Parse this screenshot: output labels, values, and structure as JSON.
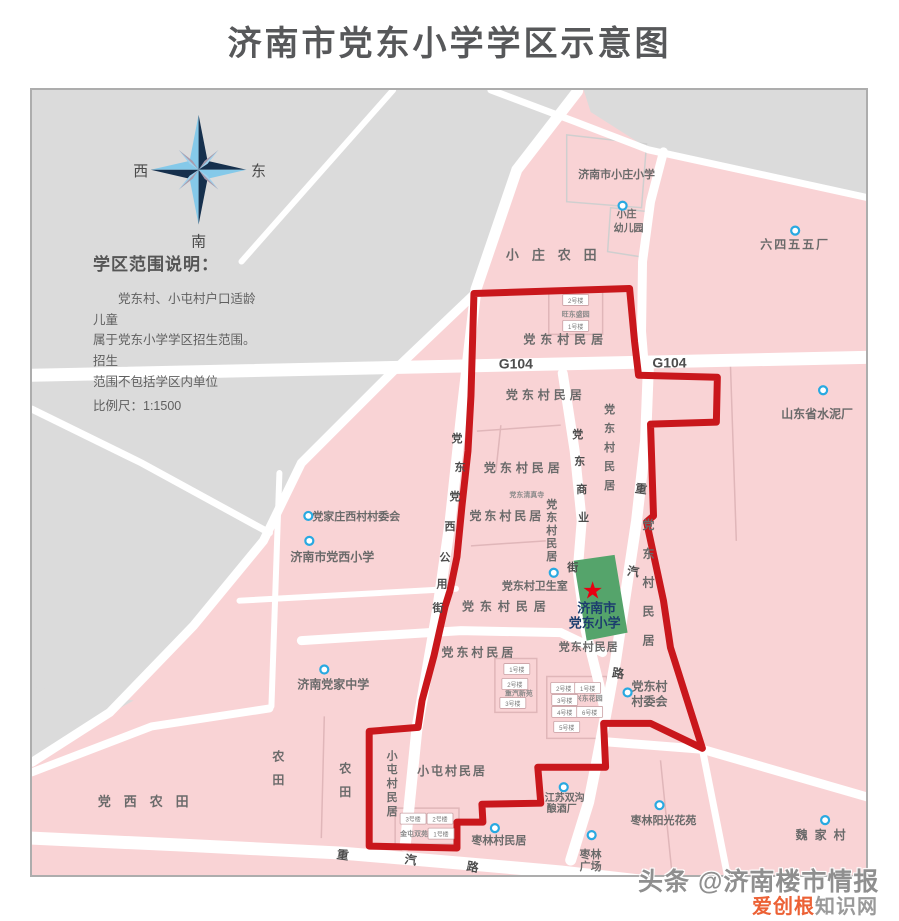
{
  "title": "济南市党东小学学区示意图",
  "compass": {
    "west": "西",
    "east": "东",
    "south": "南"
  },
  "legend": {
    "heading": "学区范围说明：",
    "body_lines": [
      "党东村、小屯村户口适龄儿童",
      "属于党东小学学区招生范围。招生",
      "范围不包括学区内单位"
    ],
    "scale_label": "比例尺：1:1500"
  },
  "school": {
    "name_line1": "济南市",
    "name_line2": "党东小学"
  },
  "watermark": {
    "line1": "头条 @济南楼市情报",
    "brand_orange": "爱创根",
    "brand_gray": "知识网"
  },
  "colors": {
    "pink": "#f9d3d5",
    "gray": "#dbdbdb",
    "road": "#ffffff",
    "boundary_red": "#c9171c",
    "area_label": "#6a6a6a",
    "road_label": "#4d4d4d",
    "small_label": "#8a8a8a",
    "school_green": "#55a46b",
    "school_text": "#1c3d6e",
    "star_red": "#e60012",
    "marker_blue": "#29a9e1"
  },
  "map": {
    "labels": [
      {
        "t": "G104",
        "x": 515,
        "y": 367,
        "s": 14,
        "c": "road"
      },
      {
        "t": "G104",
        "x": 669,
        "y": 366,
        "s": 14,
        "c": "road"
      },
      {
        "t": "党",
        "x": 456,
        "y": 441,
        "s": 11,
        "c": "road"
      },
      {
        "t": "东",
        "x": 459,
        "y": 470,
        "s": 11,
        "c": "road"
      },
      {
        "t": "党",
        "x": 454,
        "y": 499,
        "s": 11,
        "c": "road"
      },
      {
        "t": "西",
        "x": 449,
        "y": 529,
        "s": 11,
        "c": "road"
      },
      {
        "t": "公",
        "x": 444,
        "y": 560,
        "s": 11,
        "c": "road"
      },
      {
        "t": "用",
        "x": 441,
        "y": 587,
        "s": 11,
        "c": "road"
      },
      {
        "t": "街",
        "x": 437,
        "y": 611,
        "s": 11,
        "c": "road"
      },
      {
        "t": "党",
        "x": 577,
        "y": 437,
        "s": 11,
        "c": "road"
      },
      {
        "t": "东",
        "x": 579,
        "y": 464,
        "s": 11,
        "c": "road"
      },
      {
        "t": "商",
        "x": 581,
        "y": 492,
        "s": 11,
        "c": "road"
      },
      {
        "t": "业",
        "x": 583,
        "y": 520,
        "s": 11,
        "c": "road"
      },
      {
        "t": "街",
        "x": 572,
        "y": 570,
        "s": 11,
        "c": "road"
      },
      {
        "t": "重",
        "x": 640,
        "y": 492,
        "s": 12,
        "c": "road",
        "r": 8
      },
      {
        "t": "汽",
        "x": 632,
        "y": 575,
        "s": 12,
        "c": "road",
        "r": 8
      },
      {
        "t": "路",
        "x": 617,
        "y": 677,
        "s": 12,
        "c": "road",
        "r": 8
      },
      {
        "t": "重",
        "x": 341,
        "y": 859,
        "s": 12,
        "c": "road",
        "r": 8
      },
      {
        "t": "汽",
        "x": 409,
        "y": 864,
        "s": 12,
        "c": "road",
        "r": 8
      },
      {
        "t": "路",
        "x": 471,
        "y": 871,
        "s": 12,
        "c": "road",
        "r": 10
      },
      {
        "t": "小庄农田",
        "x": 557,
        "y": 258,
        "s": 13,
        "ls": 13
      },
      {
        "t": "济南市小庄小学",
        "x": 616,
        "y": 176,
        "s": 11
      },
      {
        "t": "小庄",
        "x": 626,
        "y": 216,
        "s": 10
      },
      {
        "t": "幼儿园",
        "x": 628,
        "y": 230,
        "s": 10
      },
      {
        "t": "六四五五厂",
        "x": 795,
        "y": 247,
        "s": 12,
        "ls": 2
      },
      {
        "t": "党东村民居",
        "x": 565,
        "y": 342,
        "s": 12,
        "ls": 5
      },
      {
        "t": "党东村民居",
        "x": 545,
        "y": 398,
        "s": 12,
        "ls": 4
      },
      {
        "t": "党东村民居",
        "x": 609,
        "y": 412,
        "s": 11,
        "v": 1,
        "sp": 19
      },
      {
        "t": "党东村民居",
        "x": 523,
        "y": 471,
        "s": 12,
        "ls": 4
      },
      {
        "t": "党东清真寺",
        "x": 526,
        "y": 496,
        "s": 7,
        "c": "small"
      },
      {
        "t": "党东村民居",
        "x": 506,
        "y": 519,
        "s": 12,
        "ls": 3
      },
      {
        "t": "党东村民居",
        "x": 551,
        "y": 507,
        "s": 11,
        "v": 1,
        "sp": 13
      },
      {
        "t": "党东村卫生室",
        "x": 534,
        "y": 589,
        "s": 11
      },
      {
        "t": "党东村民居",
        "x": 506,
        "y": 610,
        "s": 12,
        "ls": 6
      },
      {
        "t": "党东村民居",
        "x": 478,
        "y": 656,
        "s": 12,
        "ls": 3
      },
      {
        "t": "党东村民居",
        "x": 588,
        "y": 650,
        "s": 11,
        "ls": 1
      },
      {
        "t": "党东村民居",
        "x": 648,
        "y": 528,
        "s": 12,
        "v": 1,
        "sp": 29
      },
      {
        "t": "党东村",
        "x": 649,
        "y": 690,
        "s": 12
      },
      {
        "t": "村委会",
        "x": 649,
        "y": 705,
        "s": 12
      },
      {
        "t": "山东省水泥厂",
        "x": 817,
        "y": 417,
        "s": 12
      },
      {
        "t": "党家庄西村村委会",
        "x": 355,
        "y": 519,
        "s": 11
      },
      {
        "t": "济南市党西小学",
        "x": 331,
        "y": 560,
        "s": 12
      },
      {
        "t": "济南党家中学",
        "x": 332,
        "y": 688,
        "s": 12
      },
      {
        "t": "党西农田",
        "x": 148,
        "y": 806,
        "s": 13,
        "ls": 13
      },
      {
        "t": "农田",
        "x": 277,
        "y": 760,
        "s": 12,
        "v": 1,
        "sp": 24
      },
      {
        "t": "农田",
        "x": 344,
        "y": 772,
        "s": 12,
        "v": 1,
        "sp": 24
      },
      {
        "t": "小屯村民居",
        "x": 391,
        "y": 759,
        "s": 11,
        "v": 1,
        "sp": 14
      },
      {
        "t": "小屯村民居",
        "x": 451,
        "y": 775,
        "s": 12,
        "ls": 2
      },
      {
        "t": "枣林村民居",
        "x": 498,
        "y": 844,
        "s": 11
      },
      {
        "t": "江苏双沟",
        "x": 564,
        "y": 801,
        "s": 10
      },
      {
        "t": "酿酒厂",
        "x": 561,
        "y": 812,
        "s": 10
      },
      {
        "t": "枣林",
        "x": 590,
        "y": 858,
        "s": 11
      },
      {
        "t": "广场",
        "x": 590,
        "y": 870,
        "s": 11
      },
      {
        "t": "枣林阳光花苑",
        "x": 663,
        "y": 824,
        "s": 11
      },
      {
        "t": "魏家村",
        "x": 824,
        "y": 839,
        "s": 12,
        "ls": 7
      },
      {
        "t": "旺东盛园",
        "x": 575,
        "y": 315,
        "s": 7,
        "c": "small"
      },
      {
        "t": "重汽新苑",
        "x": 518,
        "y": 695,
        "s": 7,
        "c": "small"
      },
      {
        "t": "兴东花园",
        "x": 588,
        "y": 700,
        "s": 7,
        "c": "small"
      },
      {
        "t": "金屯双苑",
        "x": 413,
        "y": 836,
        "s": 7,
        "c": "small"
      }
    ],
    "boxes": [
      {
        "t": "2号楼",
        "x": 575,
        "y": 299
      },
      {
        "t": "1号楼",
        "x": 575,
        "y": 325
      },
      {
        "t": "1号楼",
        "x": 516,
        "y": 669
      },
      {
        "t": "2号楼",
        "x": 514,
        "y": 684
      },
      {
        "t": "3号楼",
        "x": 512,
        "y": 703
      },
      {
        "t": "2号楼",
        "x": 563,
        "y": 688
      },
      {
        "t": "1号楼",
        "x": 587,
        "y": 688
      },
      {
        "t": "3号楼",
        "x": 564,
        "y": 700
      },
      {
        "t": "4号楼",
        "x": 564,
        "y": 712
      },
      {
        "t": "5号楼",
        "x": 566,
        "y": 727
      },
      {
        "t": "6号楼",
        "x": 589,
        "y": 712
      },
      {
        "t": "3号楼",
        "x": 412,
        "y": 819
      },
      {
        "t": "2号楼",
        "x": 439,
        "y": 819
      },
      {
        "t": "1号楼",
        "x": 440,
        "y": 834
      }
    ],
    "markers": [
      {
        "x": 622,
        "y": 204
      },
      {
        "x": 795,
        "y": 229
      },
      {
        "x": 823,
        "y": 389
      },
      {
        "x": 307,
        "y": 515
      },
      {
        "x": 308,
        "y": 540
      },
      {
        "x": 323,
        "y": 669
      },
      {
        "x": 553,
        "y": 572
      },
      {
        "x": 627,
        "y": 692
      },
      {
        "x": 563,
        "y": 787
      },
      {
        "x": 494,
        "y": 828
      },
      {
        "x": 591,
        "y": 835
      },
      {
        "x": 659,
        "y": 805
      },
      {
        "x": 825,
        "y": 820
      }
    ]
  }
}
